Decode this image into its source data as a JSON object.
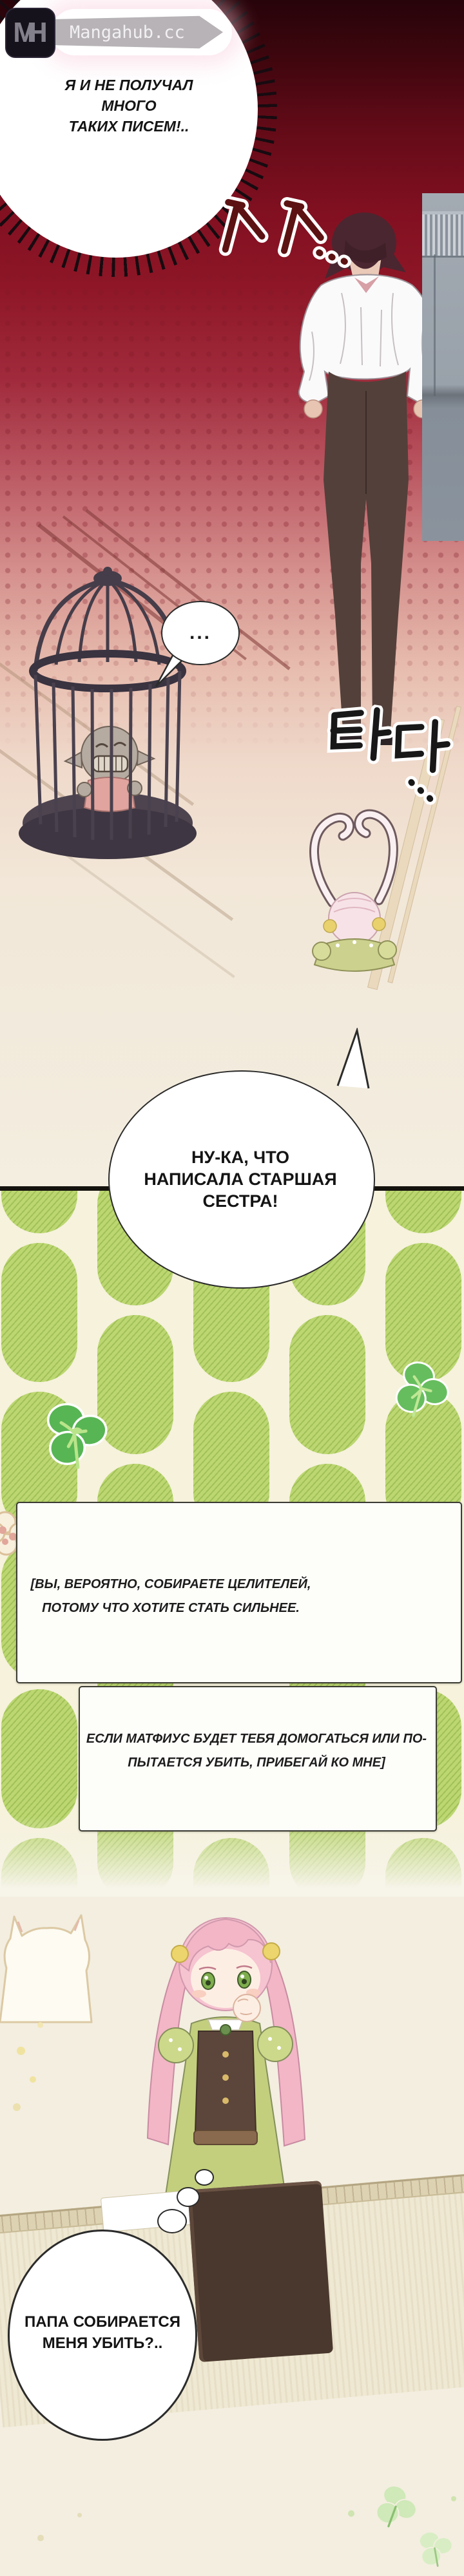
{
  "site": {
    "logo_initials": "MH",
    "logo_text": "Mangahub.cc"
  },
  "dialogue": {
    "burst_line1": "Я И НЕ ПОЛУЧАЛ МНОГО",
    "burst_line2": "ТАКИХ ПИСЕМ!..",
    "ellipsis": "...",
    "sister_line1": "НУ-КА, ЧТО",
    "sister_line2": "НАПИСАЛА СТАРШАЯ",
    "sister_line3": "СЕСТРА!",
    "thought_line1": "ПАПА СОБИРАЕТСЯ",
    "thought_line2": "МЕНЯ УБИТЬ?.."
  },
  "letter": {
    "box1_line1": "[ВЫ, ВЕРОЯТНО, СОБИРАЕТЕ ЦЕЛИТЕЛЕЙ,",
    "box1_line2": "ПОТОМУ ЧТО ХОТИТЕ СТАТЬ СИЛЬНЕЕ.",
    "box2_line1": "ЕСЛИ МАТФИУС БУДЕТ ТЕБЯ ДОМОГАТЬСЯ ИЛИ ПО-",
    "box2_line2": "ПЫТАЕТСЯ УБИТЬ, ПРИБЕГАЙ КО МНЕ]"
  },
  "sfx": {
    "rustle": "ㅅㅅ...",
    "tada": "타다..."
  },
  "colors": {
    "top_red": "#8c1220",
    "cream": "#f3eee0",
    "pattern_green": "#bcd771",
    "pattern_bg": "#f6f2dc",
    "panel_border": "#15130e",
    "clover_green": "#57b554"
  }
}
